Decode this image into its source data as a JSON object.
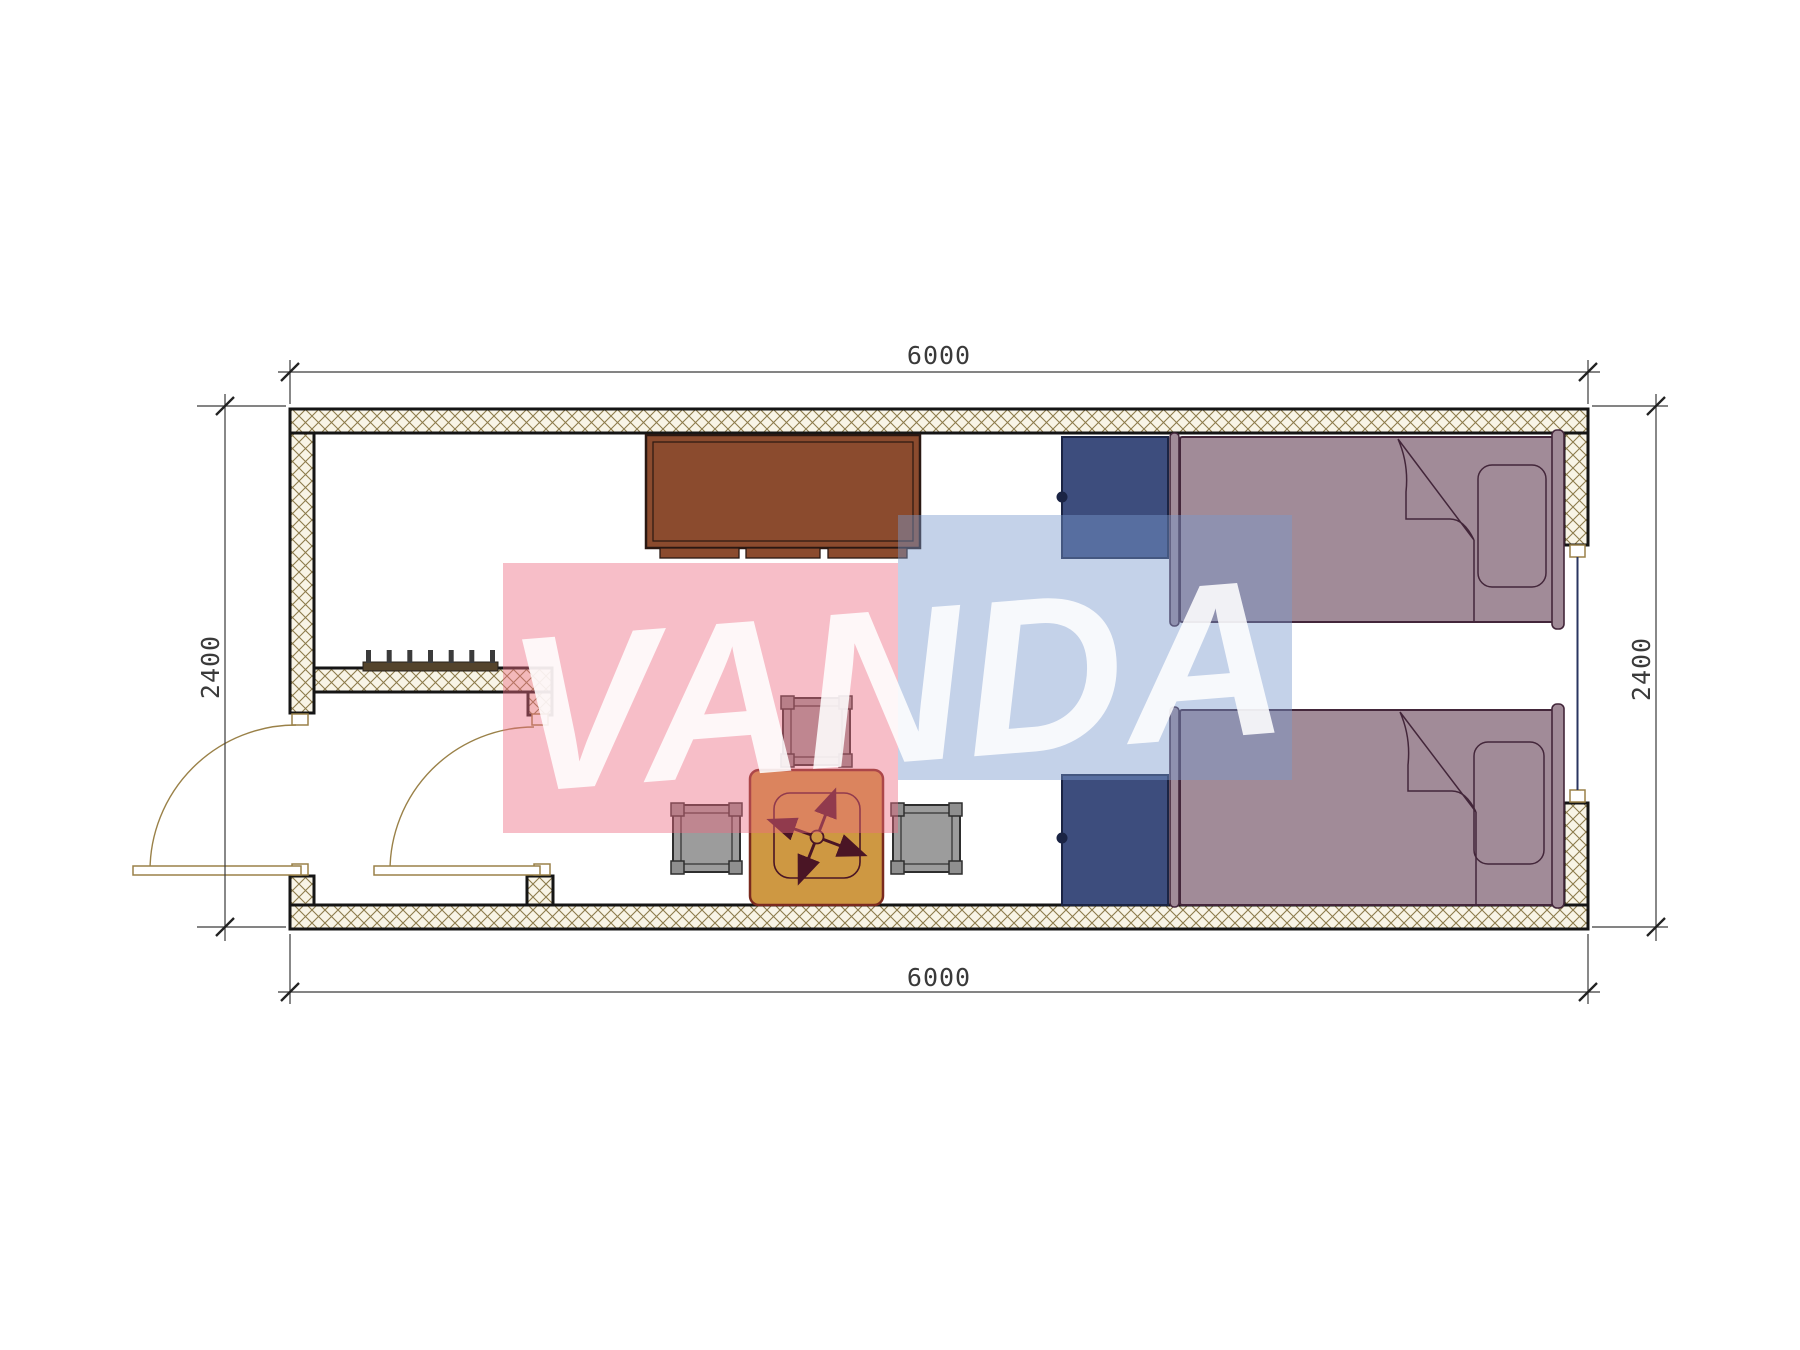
{
  "title": "Container house floor plan 6000x2400 with two beds",
  "watermark": {
    "text": "VANDA",
    "pink_color": "#ED6B81",
    "blue_color": "#7899CC",
    "text_color": "#FFFFFF"
  },
  "dimensions": {
    "top": "6000",
    "bottom": "6000",
    "left": "2400",
    "right": "2400"
  },
  "colors": {
    "wall_hatch_line": "#8c7b4b",
    "wall_hatch_bg": "#F8F4E6",
    "wall_outline": "#151515",
    "door_symbol": "#9a8148",
    "window_glazing": "#2A3560",
    "cabinet": "#8B4B2E",
    "coat_rack": "#54442C",
    "wardrobe": "#3D4D7D",
    "bed": "#A18B98",
    "bed_outline": "#43263A",
    "table": "#CE9842",
    "table_outline": "#7A2A1E",
    "chair_symbol": "#4A1525",
    "stool": "#9C9C9C",
    "dimension_lines": "#3a3a3a"
  },
  "furniture": [
    "storage-cabinet",
    "coat-rack",
    "wardrobe-upper",
    "wardrobe-lower",
    "single-bed-upper",
    "single-bed-lower",
    "square-table",
    "swivel-chair",
    "stool-top",
    "stool-left",
    "stool-right"
  ],
  "openings": [
    "exterior-door",
    "interior-door",
    "window-right-wall"
  ]
}
